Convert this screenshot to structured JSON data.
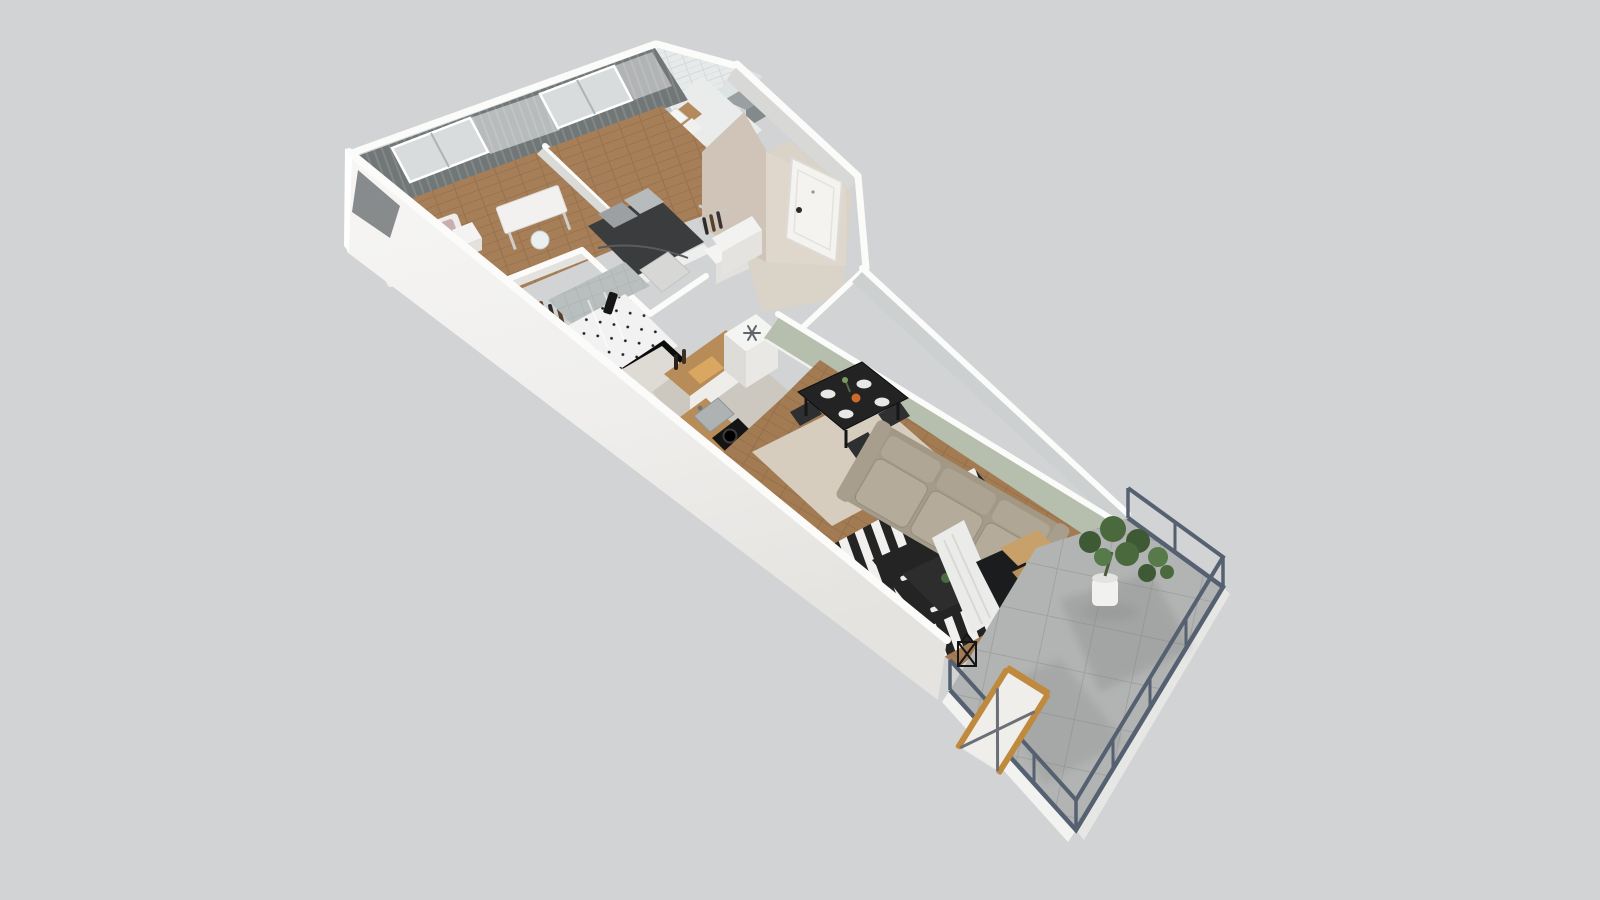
{
  "scene": {
    "label": "3D isometric cutaway floor plan render of a one-bedroom-plus apartment with balcony",
    "view": "axonometric top-down",
    "background_color": "#d2d3d4"
  },
  "palette": {
    "exterior_wall_white": "#f6f5f3",
    "wall_cap_white": "#fbfbfa",
    "interior_gray_wall": "#cdd0d0",
    "hallway_beige_wall": "#cfc4b7",
    "living_green_wall": "#b6bfad",
    "wood_floor": "#a27b55",
    "bath_tile": "#e9eceb",
    "balcony_tile": "#b2b4b3",
    "railing_dark": "#556070",
    "sofa_beige": "#a59b8b",
    "rug_black": "#232423",
    "rug_white": "#f1f0ee",
    "dining_black": "#222322",
    "curtain_gray": "#747879",
    "plant_green": "#4a6a3e",
    "counter_wood": "#b88c59",
    "bed_blanket_dark": "#3b3c3e"
  },
  "rooms": [
    {
      "name": "kids-bedroom",
      "furniture": [
        "single-bed",
        "nightstand",
        "desk",
        "desk-chair",
        "wardrobe-rack",
        "window-with-curtains"
      ]
    },
    {
      "name": "main-bedroom",
      "furniture": [
        "double-bed",
        "open-wardrobe",
        "dresser",
        "window-with-curtains"
      ]
    },
    {
      "name": "bathroom",
      "furniture": [
        "mirror",
        "vanity-sink",
        "toilet",
        "tiled-walls"
      ]
    },
    {
      "name": "shower-room",
      "furniture": [
        "glass-shower",
        "towel",
        "dotted-tile-floor"
      ]
    },
    {
      "name": "entry-hall",
      "furniture": [
        "entry-door",
        "shoe-cabinet",
        "coat-rack"
      ]
    },
    {
      "name": "kitchen",
      "furniture": [
        "fridge",
        "counter-with-sink",
        "cooktop",
        "cutting-board"
      ]
    },
    {
      "name": "dining-area",
      "furniture": [
        "black-table",
        "four-chairs",
        "plates",
        "beige-rug"
      ]
    },
    {
      "name": "living-room",
      "furniture": [
        "three-seat-sofa",
        "striped-rug",
        "coffee-table",
        "tv-panel",
        "sideboard",
        "sheer-curtain"
      ]
    },
    {
      "name": "balcony",
      "furniture": [
        "metal-railing",
        "potted-plant",
        "lounge-chair",
        "lantern",
        "concrete-tile-floor"
      ]
    }
  ]
}
